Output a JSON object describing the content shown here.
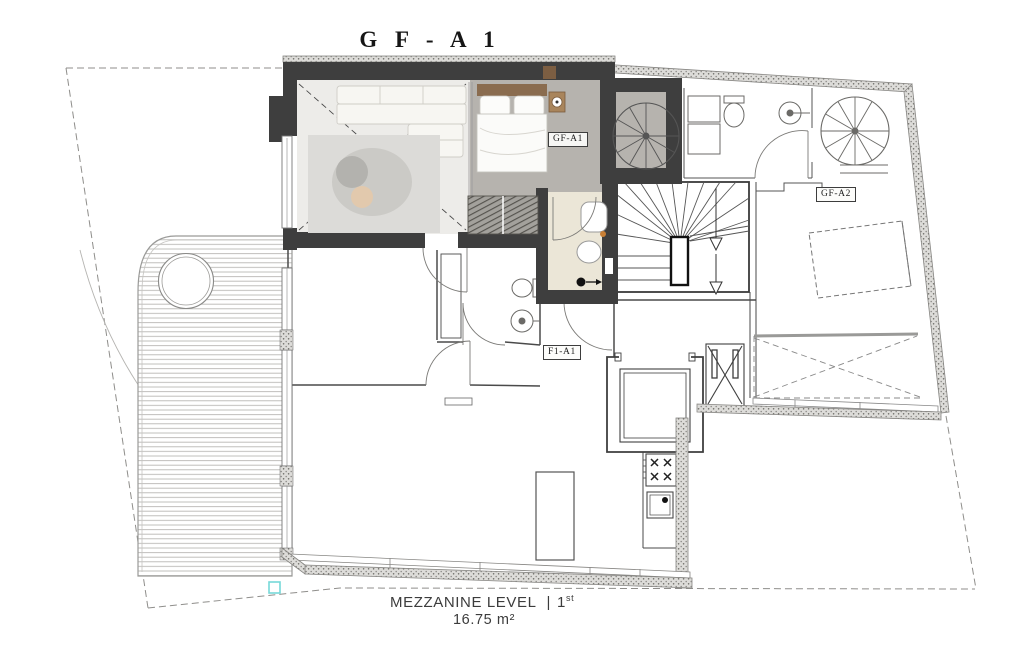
{
  "title": "G F - A 1",
  "unit_labels": {
    "gf_a1": "GF-A1",
    "gf_a2": "GF-A2",
    "f1_a1": "F1-A1"
  },
  "footer": {
    "level": "MEZZANINE LEVEL",
    "separator": "|",
    "floor_number": "1",
    "floor_suffix": "st",
    "area": "16.75 m²"
  },
  "colors": {
    "wall_dark": "#3e3e3e",
    "concrete_floor": "#b6b3ae",
    "living_floor": "#edecE9",
    "bath_floor": "#ebe6d7",
    "rug": "#dcdbd8",
    "wood": "#8a6c4f",
    "accent_teal": "#76d8d8",
    "thin_line": "#4a4a4a"
  }
}
